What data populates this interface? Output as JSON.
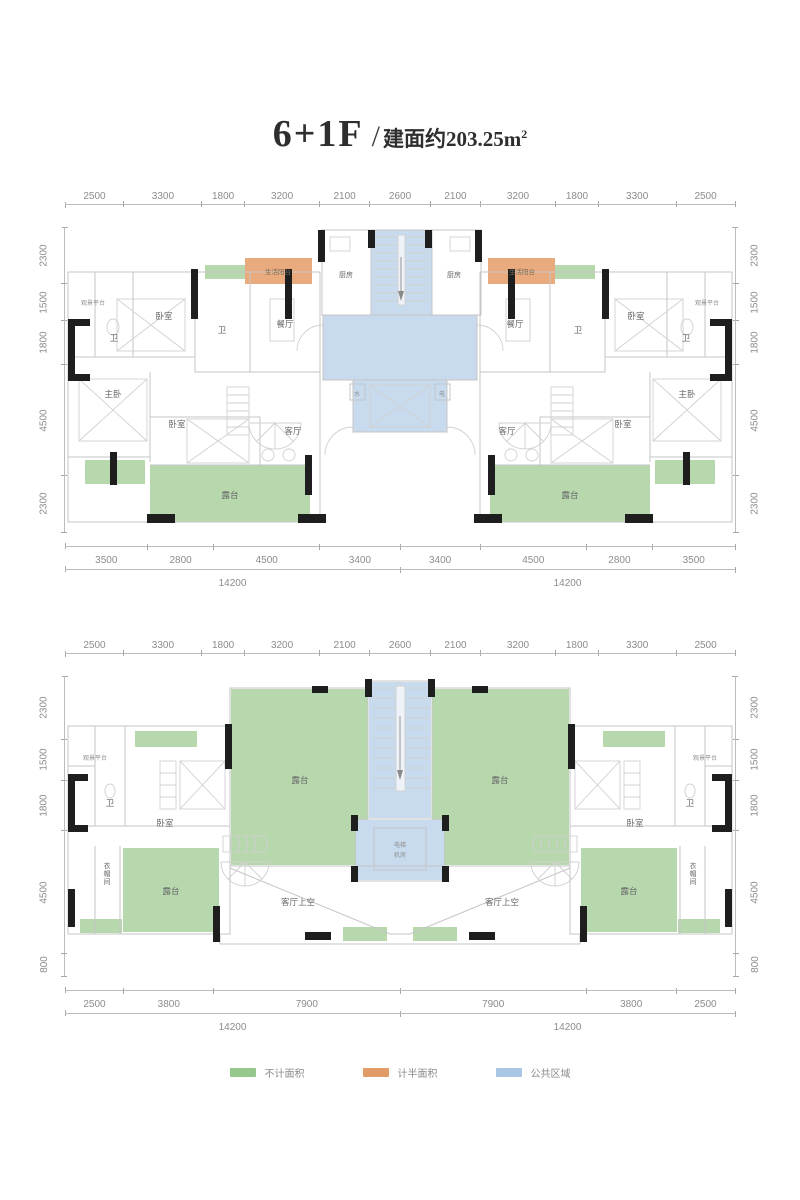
{
  "title": {
    "floors": "6+1F",
    "slash": "/",
    "area_prefix": "建面约203.25m",
    "area_sup": "2"
  },
  "colors": {
    "green": "#b7d8ac",
    "orange": "#e9ab7d",
    "blue": "#c8dbee"
  },
  "plan1": {
    "dims_top": [
      "2500",
      "3300",
      "1800",
      "3200",
      "2100",
      "2600",
      "2100",
      "3200",
      "1800",
      "3300",
      "2500"
    ],
    "dims_left": [
      "2300",
      "1500",
      "1800",
      "4500",
      "2300"
    ],
    "dims_right": [
      "2300",
      "1500",
      "1800",
      "4500",
      "2300"
    ],
    "dims_bottom": [
      "3500",
      "2800",
      "4500",
      "3400",
      "3400",
      "4500",
      "2800",
      "3500"
    ],
    "totals": [
      "14200",
      "14200"
    ],
    "labels": {
      "viewing": "观景平台",
      "bath": "卫",
      "bedroom": "卧室",
      "master": "主卧",
      "living": "客厅",
      "dining": "餐厅",
      "kitchen": "厨房",
      "life_balcony": "生活阳台",
      "terrace": "露台",
      "water": "水",
      "elec": "电"
    }
  },
  "plan2": {
    "dims_top": [
      "2500",
      "3300",
      "1800",
      "3200",
      "2100",
      "2600",
      "2100",
      "3200",
      "1800",
      "3300",
      "2500"
    ],
    "dims_left": [
      "2300",
      "1500",
      "1800",
      "4500",
      "800"
    ],
    "dims_right": [
      "2300",
      "1500",
      "1800",
      "4500",
      "800"
    ],
    "dims_bottom": [
      "2500",
      "3800",
      "7900",
      "7900",
      "3800",
      "2500"
    ],
    "totals": [
      "14200",
      "14200"
    ],
    "labels": {
      "viewing": "观景平台",
      "bath": "卫",
      "bedroom": "卧室",
      "cloak": "衣帽间",
      "terrace": "露台",
      "living_void": "客厅上空",
      "elev_line1": "电梯",
      "elev_line2": "机房"
    }
  },
  "legend": {
    "items": [
      {
        "label": "不计面积",
        "color": "#96c88e"
      },
      {
        "label": "计半面积",
        "color": "#e19b66"
      },
      {
        "label": "公共区域",
        "color": "#a9c6e5"
      }
    ]
  }
}
